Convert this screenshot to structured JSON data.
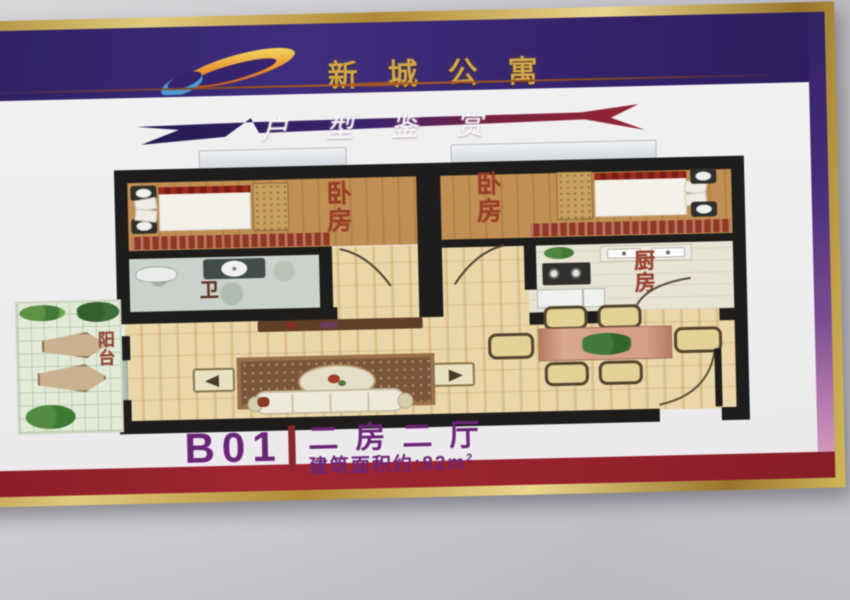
{
  "scene": {
    "wall_color": "#c9c8cd"
  },
  "poster": {
    "frame_color": "#c9a23c",
    "header": {
      "title": "新城公寓",
      "title_color": "#d8a83e",
      "bg_color": "#34216f",
      "logo_name": "comet-swoosh-logo"
    },
    "banner": {
      "text": "户型鉴赏",
      "text_color": "#ffffff",
      "gradient": [
        "#221850",
        "#3a2070",
        "#952030"
      ]
    },
    "floorplan": {
      "label_color": "#9c3a24",
      "rooms": [
        {
          "id": "bedroom-left",
          "label": "卧房"
        },
        {
          "id": "bedroom-right",
          "label": "卧房"
        },
        {
          "id": "bathroom",
          "label": "卫"
        },
        {
          "id": "kitchen",
          "label": "厨房"
        },
        {
          "id": "balcony",
          "label": "阳台"
        }
      ]
    },
    "caption": {
      "unit": "B01",
      "layout": "二房二厅",
      "area_text": "建筑面积约:82m",
      "area_sup": "2",
      "text_color": "#6d2179",
      "divider_color": "#8e2531"
    },
    "footer_band_color": "#9b1f29"
  }
}
